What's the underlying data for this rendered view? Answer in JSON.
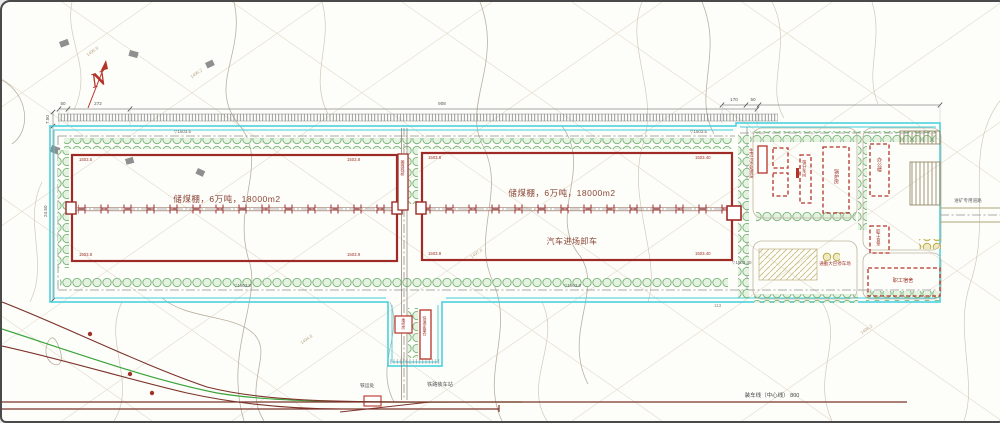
{
  "plan": {
    "north": "N",
    "left_shed": {
      "label": "储煤棚，6万吨，18000m2"
    },
    "right_shed": {
      "label": "储煤棚，6万吨，18000m2",
      "note": "汽车进场卸车"
    },
    "corner_elevations": {
      "ls_tl": "1503.5",
      "ls_tr": "1503.8",
      "ls_bl": "1503.8",
      "ls_br": "1503.9",
      "rs_tl": "1503.8",
      "rs_tr": "1503.40",
      "rs_bl": "1503.8",
      "rs_br": "1503.40"
    },
    "buildings": {
      "sewage": "生活污水处理站",
      "screening": "筛分车间",
      "boiler": "锅炉房",
      "office": "办公楼",
      "canteen": "职工食堂",
      "dormitory": "职工宿舍",
      "parking": "通勤大巴停车场",
      "conveyor_gallery": "输煤栈桥",
      "loading_bunker": "快速定量仓",
      "weighbridge": "地磅房",
      "rail_office": "铁运处"
    },
    "labels": {
      "rail_station": "铁路装车站",
      "rail_line": "装车线（中心线）  800",
      "exit_road": "进矿专用道路"
    },
    "dimensions": {
      "top_1": "50",
      "top_2": "272",
      "top_3": "908",
      "right_1": "170",
      "right_2": "50",
      "left_1": "7.50",
      "left_2": "24.50",
      "bottom_1": "113"
    },
    "elevations": {
      "e1": "1503.5",
      "e2": "1503.5",
      "e3": "1503.8",
      "e4": "1503.8",
      "e5": "1503.40"
    },
    "contour_labels": {
      "c1": "1495.9",
      "c2": "1495.2",
      "c3": "1497.6",
      "c4": "1494.8",
      "c5": "1496.3"
    }
  }
}
